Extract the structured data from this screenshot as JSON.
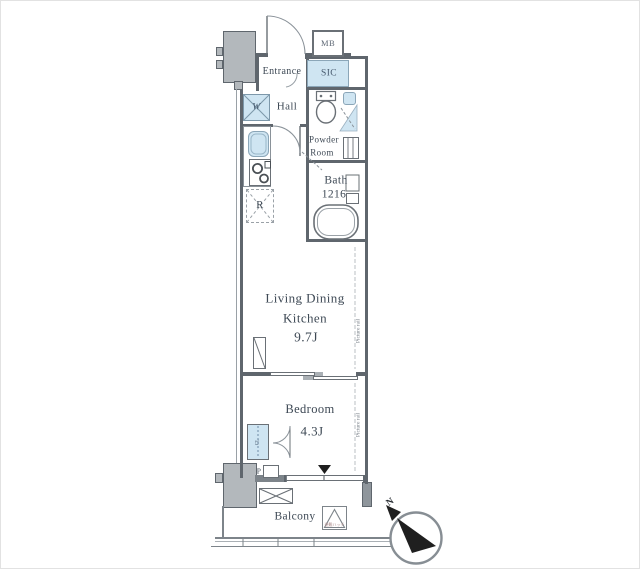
{
  "title": "Floor plan",
  "colors": {
    "wall": "#5f666d",
    "fixture_blue": "#cfe5f2",
    "gray_block": "#b3b8bc",
    "label_text": "#3e4955",
    "compass_needle": "#1f1f1f"
  },
  "rooms": {
    "mb": "MB",
    "entrance": "Entrance",
    "sic": "SIC",
    "hall": "Hall",
    "powder_line1": "Powder",
    "powder_line2": "Room",
    "bath_line1": "Bath",
    "bath_line2": "1216",
    "ldk_line1": "Living Dining",
    "ldk_line2": "Kitchen",
    "ldk_size": "9.7J",
    "bedroom": "Bedroom",
    "bedroom_size": "4.3J",
    "balcony": "Balcony"
  },
  "fixtures": {
    "washer": "W",
    "refrigerator": "R",
    "closet": "CL",
    "pipe": "P",
    "evacuation_hatch": "避難ハッチ"
  },
  "annotations": {
    "picture_rail_ldk": "Picture rail",
    "picture_rail_bedroom": "Picture rail",
    "compass_north": "N"
  }
}
